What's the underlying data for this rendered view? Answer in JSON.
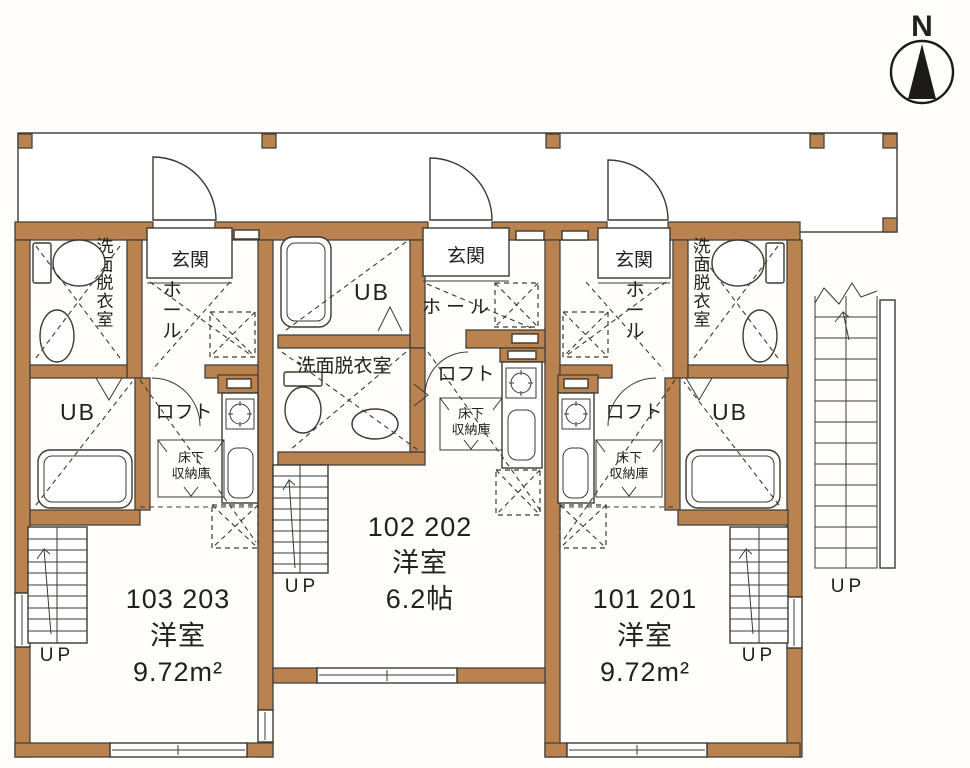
{
  "compass": {
    "label": "N"
  },
  "units": {
    "left": {
      "unit_numbers": "103 203",
      "room_type": "洋室",
      "room_size": "9.72m²",
      "genkan": "玄関",
      "hall": "ホール",
      "washroom": "洗面脱衣室",
      "bath": "UB",
      "loft": "ロフト",
      "storage_line1": "床下",
      "storage_line2": "収納庫",
      "stairs_label": "UP"
    },
    "middle": {
      "unit_numbers": "102 202",
      "room_type": "洋室",
      "room_size": "6.2帖",
      "genkan": "玄関",
      "hall": "ホール",
      "washroom": "洗面脱衣室",
      "bath": "UB",
      "loft": "ロフト",
      "storage_line1": "床下",
      "storage_line2": "収納庫",
      "stairs_label": "UP"
    },
    "right": {
      "unit_numbers": "101 201",
      "room_type": "洋室",
      "room_size": "9.72m²",
      "genkan": "玄関",
      "hall": "ホール",
      "washroom": "洗面脱衣室",
      "bath": "UB",
      "loft": "ロフト",
      "storage_line1": "床下",
      "storage_line2": "収納庫",
      "stairs_label": "UP"
    }
  },
  "exterior_stairs": {
    "stairs_label": "UP"
  },
  "icon_names": [
    "north-compass-icon",
    "toilet-icon",
    "washbasin-icon",
    "bathtub-icon",
    "gas-stove-icon",
    "kitchen-sink-icon",
    "door-swing-icon",
    "stairs-icon",
    "hatched-opening-icon",
    "underfloor-storage-icon",
    "window-icon"
  ],
  "colors": {
    "wall-fill": "#b9824e",
    "wall-stroke": "#46413a",
    "line": "#3d3930"
  }
}
